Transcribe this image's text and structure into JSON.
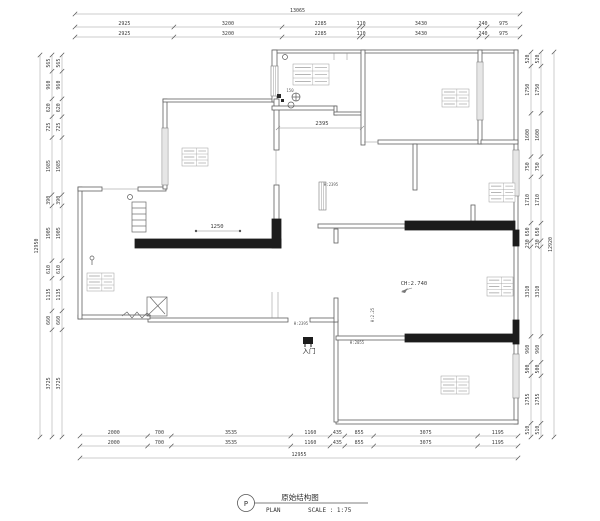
{
  "title_block": {
    "symbol": "P",
    "title": "原始结构图",
    "plan": "PLAN",
    "scale": "SCALE : 1:75"
  },
  "dims": {
    "top": {
      "total": "13065",
      "values": [
        "2925",
        "3200",
        "2285",
        "110",
        "3430",
        "240",
        "975"
      ]
    },
    "bottom": {
      "total": "12955",
      "values": [
        "2000",
        "700",
        "3535",
        "1160",
        "435",
        "855",
        "3075",
        "1195"
      ]
    },
    "left": {
      "total": "12950",
      "values": [
        "565",
        "960",
        "620",
        "725",
        "1985",
        "390",
        "1905",
        "610",
        "1135",
        "660",
        "3725"
      ]
    },
    "right": {
      "total": "12920",
      "values": [
        "520",
        "1750",
        "1600",
        "750",
        "1710",
        "650",
        "230",
        "3310",
        "960",
        "500",
        "1755",
        "510"
      ]
    }
  },
  "labels": {
    "entry": "入门",
    "ceiling": "CH:2.740",
    "dim_a": "2395",
    "dim_b": "1250",
    "h1": "H:2395",
    "h2": "H:2395",
    "h3": "H:2055",
    "h4": "H:2.25",
    "drain": "150"
  },
  "colors": {
    "wall_line": "#5f5f5f",
    "load_bearing": "#1c1c1c",
    "dim_line": "#9a9a9a",
    "dim_text": "#3a3a3a"
  }
}
